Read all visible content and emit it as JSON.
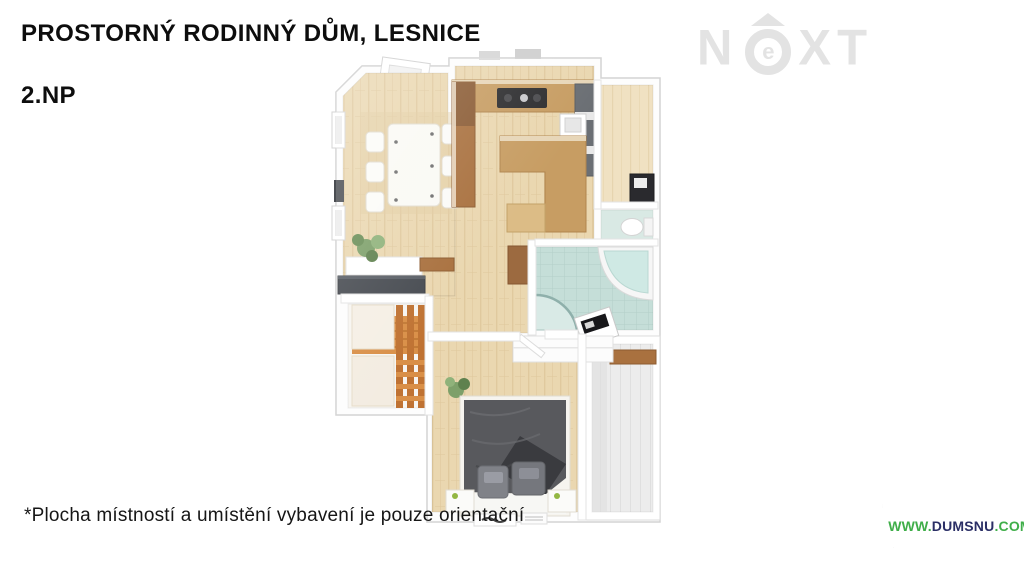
{
  "header": {
    "title": "PROSTORNÝ RODINNÝ DŮM, LESNICE",
    "floor_label": "2.NP"
  },
  "watermark": {
    "brand": "NEXT",
    "letter_n": "N",
    "letter_e": "e",
    "letters_xt": "XT"
  },
  "floorplan": {
    "rooms": [
      "dining-living-room",
      "kitchen",
      "hallway",
      "wc",
      "bathroom",
      "staircase",
      "bedroom",
      "terrace"
    ]
  },
  "footer": {
    "disclaimer": "*Plocha místností a umístění vybavení je pouze orientační"
  },
  "website_badge": {
    "prefix": "WWW.",
    "domain": "DUMSNU",
    "tld": ".COM"
  },
  "colors": {
    "badge_green": "#3fae49",
    "badge_navy": "#2b2f66",
    "watermark_gray": "#e3e3e3",
    "wood_floor": "#ead7b0",
    "kitchen_wood": "#c79d63",
    "bath_tile": "#c5ded8",
    "stairs_wood": "#cf8440",
    "bed_gray": "#58595d",
    "terrace_gray": "#ececec"
  }
}
